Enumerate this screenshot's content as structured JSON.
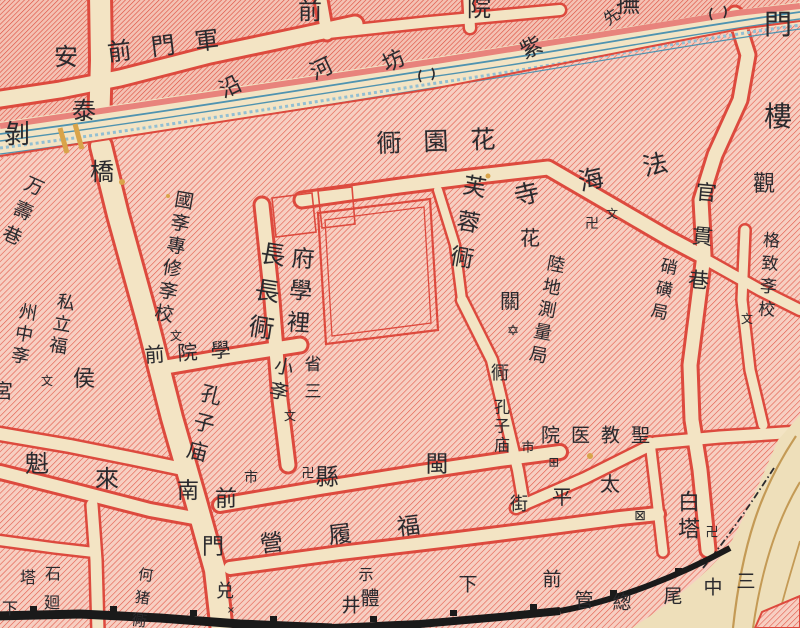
{
  "map": {
    "kind": "historical-city-map",
    "colors": {
      "paper": "#f3e4c4",
      "hatch-base": "#f7cfc2",
      "hatch-line": "#e25a4a",
      "hatch-line-dense": "#dd4c3c",
      "hatch-base-dense": "#f4c2b4",
      "border": "#dd4a3e",
      "river-line": "#4f93b0",
      "river-line-light": "#93bfd2",
      "river-band": "#e8837c",
      "ink": "#2a2a2e",
      "wall": "#1a1a1a",
      "contour": "#c49a55",
      "bridge": "#d9a44a",
      "slope": "#eedfba"
    },
    "labels": [
      {
        "t": "軍門前",
        "x": 173,
        "y": 45,
        "s": 24,
        "rot": -7,
        "rtl": true,
        "ls": 20,
        "n": "street-name-label"
      },
      {
        "t": "安",
        "x": 66,
        "y": 57,
        "s": 24,
        "n": "street-name-label"
      },
      {
        "t": "泰",
        "x": 84,
        "y": 111,
        "s": 24,
        "n": "street-name-label"
      },
      {
        "t": "橋",
        "x": 102,
        "y": 172,
        "s": 24,
        "n": "street-name-label"
      },
      {
        "t": "前",
        "x": 310,
        "y": 11,
        "s": 24,
        "n": "street-name-label"
      },
      {
        "t": "院",
        "x": 479,
        "y": 8,
        "s": 24,
        "n": "street-name-label"
      },
      {
        "t": "撫",
        "x": 628,
        "y": 4,
        "s": 24,
        "n": "street-name-label"
      },
      {
        "t": "先",
        "x": 612,
        "y": 17,
        "s": 16,
        "rot": -35,
        "n": "street-name-label"
      },
      {
        "t": "沿",
        "x": 231,
        "y": 88,
        "s": 22,
        "rot": -25,
        "n": "street-name-label"
      },
      {
        "t": "河",
        "x": 322,
        "y": 70,
        "s": 22,
        "rot": -25,
        "n": "street-name-label"
      },
      {
        "t": "坊",
        "x": 394,
        "y": 62,
        "s": 22,
        "rot": -25,
        "n": "street-name-label"
      },
      {
        "t": "紫",
        "x": 532,
        "y": 49,
        "s": 22,
        "rot": -25,
        "n": "street-name-label"
      },
      {
        "t": "門",
        "x": 778,
        "y": 25,
        "s": 28,
        "n": "street-name-label"
      },
      {
        "t": "樓",
        "x": 778,
        "y": 117,
        "s": 28,
        "n": "street-name-label"
      },
      {
        "t": "花園衕",
        "x": 447,
        "y": 141,
        "s": 25,
        "rtl": true,
        "ls": 22,
        "rot": -2,
        "n": "street-name-label"
      },
      {
        "t": "芙蓉衕",
        "x": 464,
        "y": 227,
        "s": 23,
        "v": true,
        "rot": 10,
        "ls": 13,
        "n": "street-name-label"
      },
      {
        "t": "法海寺",
        "x": 611,
        "y": 175,
        "s": 25,
        "rtl": true,
        "rot": -13,
        "ls": 41,
        "n": "temple-name-label"
      },
      {
        "t": "卍",
        "x": 592,
        "y": 224,
        "s": 14,
        "n": "temple-mark"
      },
      {
        "t": "文",
        "x": 612,
        "y": 214,
        "s": 12,
        "n": "school-mark"
      },
      {
        "t": "官貫巷",
        "x": 700,
        "y": 247,
        "s": 21,
        "v": true,
        "rot": 5,
        "ls": 23,
        "n": "street-name-label"
      },
      {
        "t": "硝磺局",
        "x": 661,
        "y": 291,
        "s": 17,
        "v": true,
        "rot": 12,
        "ls": 6,
        "n": "bureau-name-label"
      },
      {
        "t": "格致斈校",
        "x": 766,
        "y": 277,
        "s": 17,
        "v": true,
        "rot": 4,
        "ls": 6,
        "n": "school-name-label"
      },
      {
        "t": "文",
        "x": 747,
        "y": 319,
        "s": 12,
        "n": "school-mark"
      },
      {
        "t": "觀",
        "x": 764,
        "y": 185,
        "s": 22,
        "n": "place-name-label"
      },
      {
        "t": "花",
        "x": 530,
        "y": 238,
        "s": 20,
        "n": "place-name-label"
      },
      {
        "t": "陸地測量局",
        "x": 545,
        "y": 311,
        "s": 18,
        "v": true,
        "rot": 11,
        "ls": 5,
        "n": "bureau-name-label"
      },
      {
        "t": "關",
        "x": 510,
        "y": 301,
        "s": 20,
        "n": "place-name-label"
      },
      {
        "t": "✡",
        "x": 513,
        "y": 331,
        "s": 15,
        "n": "star-mark"
      },
      {
        "t": "衕",
        "x": 500,
        "y": 374,
        "s": 18,
        "n": "street-name-label"
      },
      {
        "t": "孔子庙",
        "x": 500,
        "y": 427,
        "s": 16,
        "v": true,
        "ls": 3,
        "n": "temple-name-label"
      },
      {
        "t": "市",
        "x": 528,
        "y": 448,
        "s": 13,
        "n": "market-mark"
      },
      {
        "t": "聖教医院",
        "x": 601,
        "y": 436,
        "s": 19,
        "rtl": true,
        "ls": 11,
        "n": "hospital-name-label"
      },
      {
        "t": "⊞",
        "x": 554,
        "y": 463,
        "s": 13,
        "n": "hospital-mark"
      },
      {
        "t": "太",
        "x": 610,
        "y": 484,
        "s": 20,
        "n": "street-name-label"
      },
      {
        "t": "平",
        "x": 562,
        "y": 497,
        "s": 20,
        "n": "street-name-label"
      },
      {
        "t": "街",
        "x": 519,
        "y": 505,
        "s": 18,
        "n": "street-name-label"
      },
      {
        "t": "⊠",
        "x": 640,
        "y": 516,
        "s": 14,
        "n": "church-mark"
      },
      {
        "t": "白塔",
        "x": 686,
        "y": 517,
        "s": 22,
        "v": true,
        "ls": 5,
        "n": "pagoda-name-label"
      },
      {
        "t": "卍",
        "x": 712,
        "y": 533,
        "s": 13,
        "n": "temple-mark"
      },
      {
        "t": "前",
        "x": 552,
        "y": 580,
        "s": 19,
        "n": "street-name-label"
      },
      {
        "t": "管",
        "x": 584,
        "y": 601,
        "s": 19,
        "n": "street-name-label"
      },
      {
        "t": "緫",
        "x": 622,
        "y": 603,
        "s": 19,
        "n": "street-name-label"
      },
      {
        "t": "尾",
        "x": 673,
        "y": 597,
        "s": 19,
        "n": "street-name-label"
      },
      {
        "t": "中",
        "x": 713,
        "y": 588,
        "s": 19,
        "n": "street-name-label"
      },
      {
        "t": "三",
        "x": 746,
        "y": 582,
        "s": 19,
        "n": "street-name-label"
      },
      {
        "t": "下",
        "x": 468,
        "y": 585,
        "s": 19,
        "n": "street-name-label"
      },
      {
        "t": "閩",
        "x": 437,
        "y": 465,
        "s": 23,
        "n": "district-name-label"
      },
      {
        "t": "縣",
        "x": 327,
        "y": 478,
        "s": 23,
        "n": "district-name-label"
      },
      {
        "t": "卍",
        "x": 308,
        "y": 474,
        "s": 13,
        "n": "temple-mark"
      },
      {
        "t": "福履營",
        "x": 363,
        "y": 533,
        "s": 23,
        "rtl": true,
        "rot": -7,
        "ls": 46,
        "n": "street-name-label"
      },
      {
        "t": "示",
        "x": 366,
        "y": 575,
        "s": 15,
        "n": "place-name-label"
      },
      {
        "t": "體",
        "x": 370,
        "y": 599,
        "s": 19,
        "n": "place-name-label"
      },
      {
        "t": "井",
        "x": 351,
        "y": 606,
        "s": 19,
        "n": "place-name-label"
      },
      {
        "t": "兑",
        "x": 225,
        "y": 592,
        "s": 18,
        "n": "place-name-label"
      },
      {
        "t": "×",
        "x": 231,
        "y": 611,
        "s": 10,
        "n": "cross-mark"
      },
      {
        "t": "南",
        "x": 188,
        "y": 492,
        "s": 22,
        "n": "street-name-label"
      },
      {
        "t": "前",
        "x": 226,
        "y": 500,
        "s": 22,
        "n": "street-name-label"
      },
      {
        "t": "門",
        "x": 213,
        "y": 548,
        "s": 22,
        "n": "street-name-label"
      },
      {
        "t": "孔子庙",
        "x": 202,
        "y": 426,
        "s": 21,
        "v": true,
        "rot": 14,
        "ls": 8,
        "n": "temple-name-label"
      },
      {
        "t": "市",
        "x": 251,
        "y": 478,
        "s": 14,
        "n": "market-mark"
      },
      {
        "t": "學院前",
        "x": 194,
        "y": 352,
        "s": 20,
        "rtl": true,
        "rot": -4,
        "ls": 13,
        "n": "street-name-label"
      },
      {
        "t": "魁",
        "x": 37,
        "y": 464,
        "s": 24,
        "n": "place-name-label"
      },
      {
        "t": "來",
        "x": 107,
        "y": 479,
        "s": 24,
        "n": "place-name-label"
      },
      {
        "t": "侯",
        "x": 84,
        "y": 380,
        "s": 22,
        "n": "district-name-label"
      },
      {
        "t": "宮",
        "x": 3,
        "y": 391,
        "s": 20,
        "n": "place-name-label"
      },
      {
        "t": "私立福",
        "x": 60,
        "y": 325,
        "s": 18,
        "v": true,
        "rot": 10,
        "ls": 4,
        "n": "school-name-label"
      },
      {
        "t": "州中斈",
        "x": 22,
        "y": 335,
        "s": 18,
        "v": true,
        "rot": 10,
        "ls": 4,
        "n": "school-name-label"
      },
      {
        "t": "文",
        "x": 47,
        "y": 381,
        "s": 12,
        "n": "school-mark"
      },
      {
        "t": "國斈專修斈校",
        "x": 172,
        "y": 258,
        "s": 19,
        "v": true,
        "rot": 10,
        "ls": 4,
        "n": "school-name-label"
      },
      {
        "t": "文",
        "x": 176,
        "y": 336,
        "s": 12,
        "n": "school-mark"
      },
      {
        "t": "長長衕",
        "x": 265,
        "y": 296,
        "s": 25,
        "v": true,
        "rot": 9,
        "ls": 12,
        "n": "street-name-label"
      },
      {
        "t": "小斈",
        "x": 279,
        "y": 381,
        "s": 19,
        "v": true,
        "rot": 12,
        "ls": 6,
        "n": "school-name-label"
      },
      {
        "t": "文",
        "x": 290,
        "y": 416,
        "s": 12,
        "n": "school-mark"
      },
      {
        "t": "府學裡",
        "x": 297,
        "y": 294,
        "s": 23,
        "v": true,
        "rot": 4,
        "ls": 9,
        "n": "street-name-label"
      },
      {
        "t": "省三",
        "x": 310,
        "y": 382,
        "s": 17,
        "v": true,
        "ls": 10,
        "n": "school-name-label"
      },
      {
        "t": "万壽巷",
        "x": 20,
        "y": 213,
        "s": 19,
        "v": true,
        "rot": 24,
        "ls": 8,
        "n": "street-name-label"
      },
      {
        "t": "剝",
        "x": 17,
        "y": 135,
        "s": 26,
        "n": "street-name-label"
      },
      {
        "t": "石",
        "x": 53,
        "y": 574,
        "s": 16,
        "n": "place-name-label"
      },
      {
        "t": "塔",
        "x": 28,
        "y": 578,
        "s": 16,
        "n": "place-name-label"
      },
      {
        "t": "廻",
        "x": 52,
        "y": 603,
        "s": 16,
        "n": "place-name-label"
      },
      {
        "t": "下",
        "x": 10,
        "y": 609,
        "s": 16,
        "n": "place-name-label"
      },
      {
        "t": "何猪衕",
        "x": 141,
        "y": 601,
        "s": 15,
        "v": true,
        "rot": 8,
        "ls": 8,
        "n": "street-name-label"
      }
    ]
  }
}
